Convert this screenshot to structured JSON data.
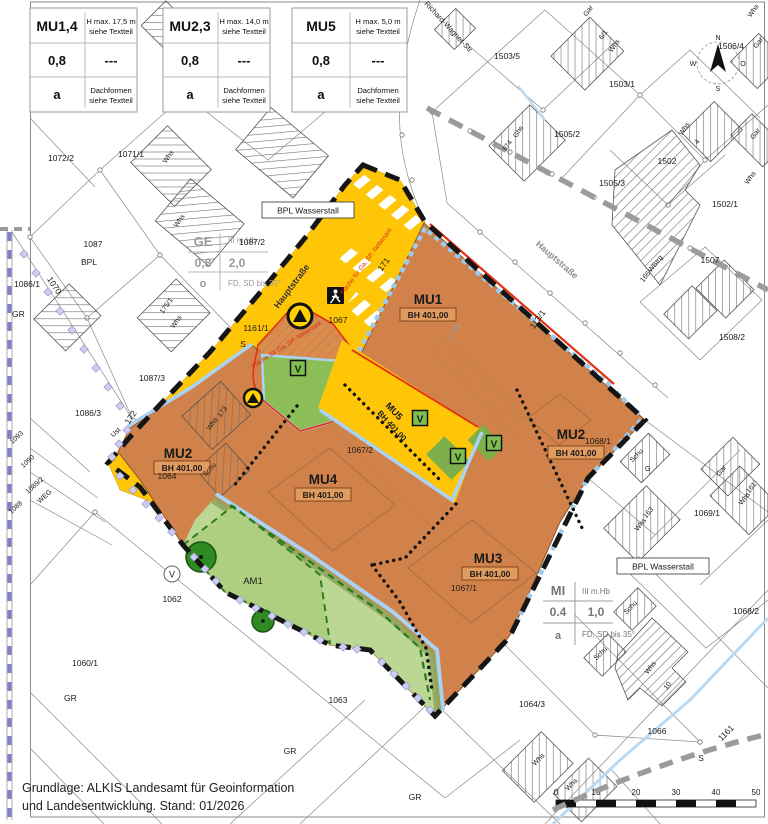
{
  "legend": [
    {
      "name": "MU1,4",
      "hmax": "H max. 17,5 m",
      "see": "siehe Textteil",
      "grz": "0,8",
      "gfz": "---",
      "open": "a",
      "roof1": "Dachformen",
      "roof2": "siehe Textteil"
    },
    {
      "name": "MU2,3",
      "hmax": "H max. 14,0 m",
      "see": "siehe Textteil",
      "grz": "0,8",
      "gfz": "---",
      "open": "a",
      "roof1": "Dachformen",
      "roof2": "siehe Textteil"
    },
    {
      "name": "MU5",
      "hmax": "H max. 5,0 m",
      "see": "siehe Textteil",
      "grz": "0,8",
      "gfz": "---",
      "open": "a",
      "roof1": "Dachformen",
      "roof2": "siehe Textteil"
    }
  ],
  "ge": {
    "name": "GE",
    "floors": "III m.Hb",
    "grz": "0,8",
    "gfz": "2,0",
    "open": "o",
    "roof": "FD, SD bis 35°"
  },
  "mi": {
    "name": "MI",
    "floors": "III m.Hb",
    "grz": "0.4",
    "gfz": "1,0",
    "open": "a",
    "roof": "FD, SD bis 35°"
  },
  "zones": {
    "mu1": "MU1",
    "mu2l": "MU2",
    "mu2r": "MU2",
    "mu3": "MU3",
    "mu4": "MU4",
    "mu5": "MU5",
    "am1": "AM1",
    "bh": "BH 401,00"
  },
  "bpl": "BPL Wasserstall",
  "red_note": "Fläche für Ga, SP, Nebenanl.",
  "streets": {
    "haupt1": "Hauptstraße",
    "haupt2": "Hauptstraße",
    "rws": "Richard-Wagner-Str."
  },
  "v": "V",
  "compass": {
    "n": "N",
    "w": "W",
    "s": "S",
    "o": "O"
  },
  "scale": [
    "0",
    "10",
    "20",
    "30",
    "40",
    "50"
  ],
  "credit1": "Grundlage: ALKIS Landesamt für Geoinformation",
  "credit2": "und Landesentwicklung. Stand: 01/2026",
  "colors": {
    "zone_orange": "#D0824A",
    "road_yellow": "#FFC608",
    "green_area": "#BCD693",
    "green_v": "#8CBE58",
    "blue_edge": "#A9D3F5",
    "red_line": "#E23010",
    "boundary": "#151515",
    "bpl_gray": "#9b9b9b",
    "lilac": "#CDCDF2"
  },
  "parcels": [
    "1072/2",
    "1071/1",
    "1087",
    "BPL",
    "1070",
    "1086/1",
    "GR",
    "1087/3",
    "1086/3",
    "172",
    "1093",
    "1090",
    "1089/2",
    "WEG",
    "1088",
    "Ust",
    "1062",
    "1060/1",
    "GR",
    "1063",
    "GR",
    "GR",
    "1064",
    "1067/2",
    "1068/1",
    "1067/1",
    "1067",
    "1161/1",
    "S",
    "171",
    "113/1",
    "Lagg",
    "173",
    "Whs",
    "Schu",
    "AM1-DUMMY",
    "1503/5",
    "1503/1",
    "6/1",
    "Whs",
    "Gar",
    "Ghs",
    "174",
    "1505/2",
    "1505/3",
    "1502",
    "1502/1",
    "1507",
    "1508/2",
    "WBtrg",
    "166",
    "Whs",
    "4",
    "Gar",
    "Whs",
    "1506/4",
    "Schu",
    "G",
    "Whs",
    "163",
    "Gar",
    "Whs",
    "161",
    "1069/1",
    "1068/2",
    "Schu",
    "Schu",
    "Whs",
    "10",
    "1066",
    "1161",
    "S",
    "1064/3",
    "Whs",
    "Whs",
    "175/1",
    "Whs",
    "Whs",
    "Whs",
    "1087/2",
    "Whs",
    "Gar"
  ]
}
